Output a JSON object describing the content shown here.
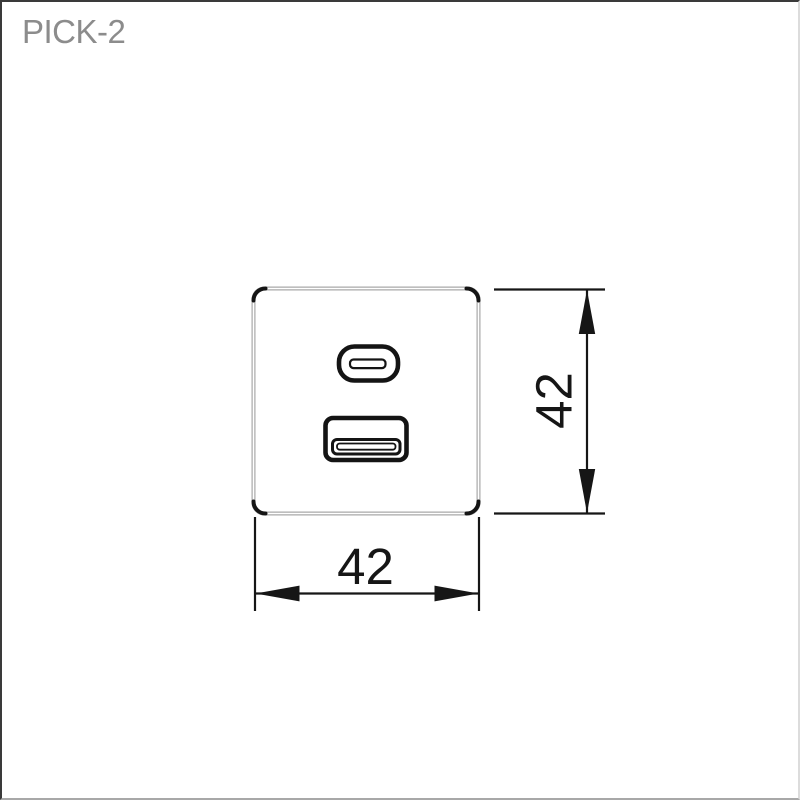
{
  "title": {
    "text": "PICK-2"
  },
  "drawing": {
    "plate": {
      "shape": "rounded-square-faceplate"
    },
    "ports": {
      "top": "usb-c",
      "bottom": "usb-a"
    },
    "dimensions": {
      "width": {
        "label": "42"
      },
      "height": {
        "label": "42"
      }
    },
    "colors": {
      "line": "#161616",
      "plate_outline": "#a8a8a8",
      "title_text": "#8c8c8c",
      "background": "#ffffff"
    }
  }
}
